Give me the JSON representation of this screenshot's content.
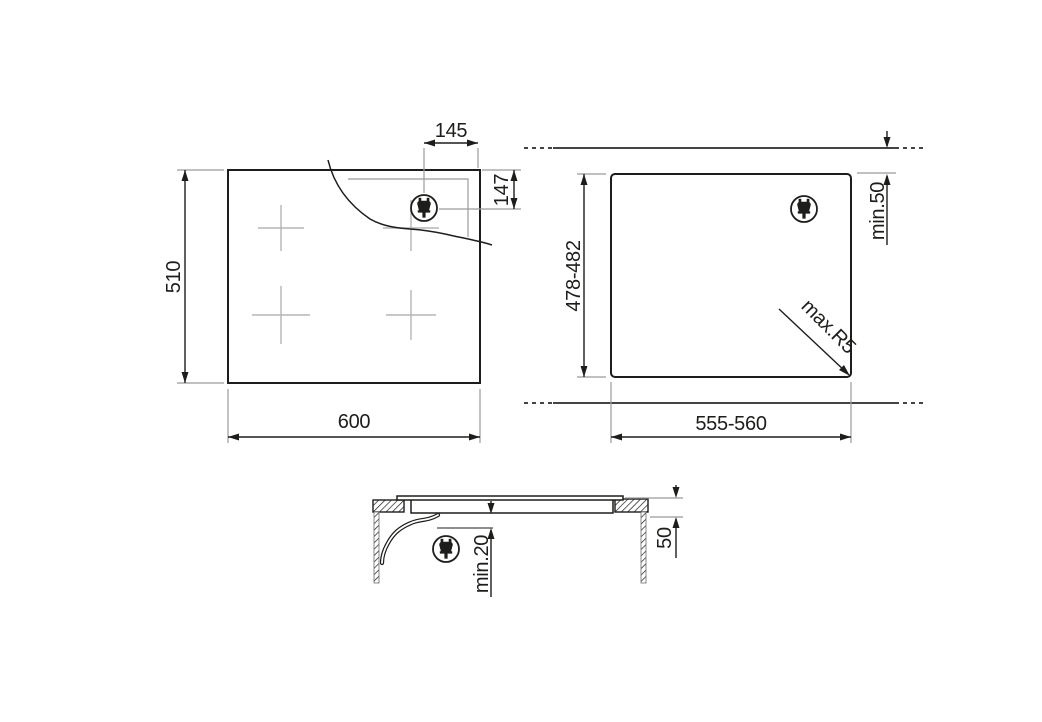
{
  "document": {
    "type": "appliance-installation-diagram",
    "subject": "built-in hob top view, worktop cutout and side section with dimensions"
  },
  "colors": {
    "line": "#1d1d1b",
    "secondary_line": "#9b9b9b",
    "burner_cross": "#b5b5b5",
    "background": "#ffffff"
  },
  "icons": {
    "power_plug": "power-plug-icon"
  },
  "views": {
    "top": {
      "name": "hob-top-view",
      "width_label": "600",
      "height_label": "510",
      "plug_offset_x_label": "145",
      "plug_offset_y_label": "147"
    },
    "cutout": {
      "name": "worktop-cutout-view",
      "width_label": "555-560",
      "height_label": "478-482",
      "rear_clearance_label": "min.50",
      "corner_radius_label": "max.R5"
    },
    "section": {
      "name": "side-section-view",
      "clearance_below_label": "min.20",
      "worktop_thickness_label": "50"
    }
  }
}
